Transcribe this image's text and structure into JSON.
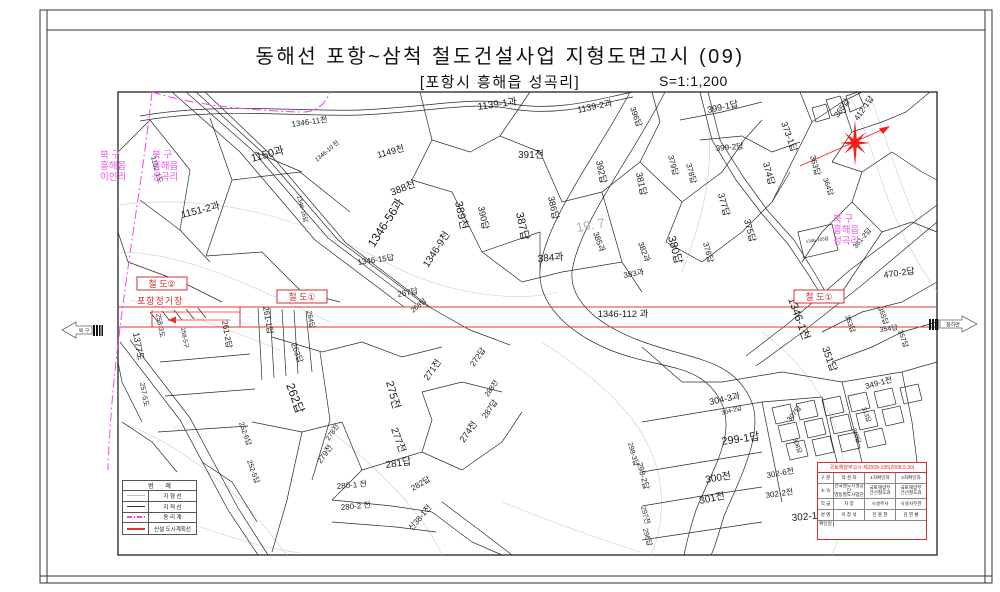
{
  "title": {
    "main": "동해선 포항~삼척 철도건설사업 지형도면고시 (09)",
    "sub": "[포항시 흥해읍 성곡리]",
    "scale": "S=1:1,200"
  },
  "colors": {
    "railway_red": "#e03434",
    "boundary_magenta": "#ff3cff",
    "admin_text_magenta": "#ee55ee",
    "cadastral_black": "#2b2b2b",
    "topo_gray": "#cdcdcd",
    "star_red": "#ff1a1a"
  },
  "edges": {
    "left": {
      "label": "북 구"
    },
    "right": {
      "label": "청하면"
    }
  },
  "rail": {
    "line_label": "1346-112 과",
    "station_label": "포항정거장",
    "boxes": [
      {
        "t": "철  도②",
        "x": 137,
        "y": 277
      },
      {
        "t": "철  도①",
        "x": 277,
        "y": 290
      },
      {
        "t": "철  도①",
        "x": 794,
        "y": 290
      }
    ]
  },
  "admin_labels": [
    {
      "x": 100,
      "y": 158,
      "lines": [
        "북   구",
        "흥해읍",
        "이인리"
      ]
    },
    {
      "x": 152,
      "y": 158,
      "lines": [
        "북   구",
        "흥해읍",
        "성곡리"
      ]
    },
    {
      "x": 833,
      "y": 222,
      "lines": [
        "북   구",
        "흥해읍",
        "성곡리"
      ]
    }
  ],
  "legend": {
    "header": "범  례",
    "items": [
      {
        "label": "지  형  선"
      },
      {
        "label": "지  적  선"
      },
      {
        "label": "동  리  계"
      },
      {
        "label": "신설 도시계획선"
      }
    ]
  },
  "title_block": {
    "header": "국토해양부고시  제2008-195(2008.5.30)",
    "rows": [
      {
        "label": "구 분",
        "cells": [
          "작 성 자",
          "1차확인자",
          "2차확인자"
        ]
      },
      {
        "label": "소 속",
        "cells": [
          "한국철도시설공단\n영동철도사업단",
          "국토해양부\n간선철도과",
          "국토해양부\n간선철도과"
        ]
      },
      {
        "label": "직 급",
        "cells": [
          "차 장",
          "시설주사",
          "시설사무관"
        ]
      },
      {
        "label": "성 명",
        "cells": [
          "이 창 석",
          "민 홍 현",
          "김 영 룡"
        ]
      },
      {
        "label": "확인일",
        "cells": [
          "",
          "",
          ""
        ]
      }
    ]
  },
  "map": {
    "parcels": [
      {
        "t": "1150과",
        "x": 252,
        "y": 162,
        "r": -15,
        "s": 11
      },
      {
        "t": "1151-2과",
        "x": 182,
        "y": 218,
        "r": -14,
        "s": 10
      },
      {
        "t": "1152-1도",
        "x": 151,
        "y": 157,
        "r": 75,
        "s": 7
      },
      {
        "t": "1346-11천",
        "x": 292,
        "y": 127,
        "r": -8,
        "s": 8
      },
      {
        "t": "1149천",
        "x": 378,
        "y": 158,
        "r": -15,
        "s": 9
      },
      {
        "t": "388천",
        "x": 392,
        "y": 196,
        "r": -22,
        "s": 10
      },
      {
        "t": "1346-56과",
        "x": 374,
        "y": 248,
        "r": -57,
        "s": 12
      },
      {
        "t": "1346-9천",
        "x": 428,
        "y": 268,
        "r": -57,
        "s": 10
      },
      {
        "t": "1346-15답",
        "x": 358,
        "y": 265,
        "r": -8,
        "s": 8
      },
      {
        "t": "1346-10 천",
        "x": 317,
        "y": 162,
        "r": -40,
        "s": 6
      },
      {
        "t": "1346-16답",
        "x": 297,
        "y": 196,
        "r": 75,
        "s": 6
      },
      {
        "t": "1139-1과",
        "x": 478,
        "y": 110,
        "r": -8,
        "s": 10
      },
      {
        "t": "1139-2과",
        "x": 578,
        "y": 113,
        "r": -12,
        "s": 9
      },
      {
        "t": "391전",
        "x": 518,
        "y": 158,
        "r": 0,
        "s": 10
      },
      {
        "t": "389천",
        "x": 455,
        "y": 202,
        "r": 78,
        "s": 11
      },
      {
        "t": "390답",
        "x": 478,
        "y": 207,
        "r": 78,
        "s": 9
      },
      {
        "t": "387답",
        "x": 516,
        "y": 213,
        "r": 78,
        "s": 11
      },
      {
        "t": "386답",
        "x": 548,
        "y": 197,
        "r": 78,
        "s": 9
      },
      {
        "t": "392답",
        "x": 596,
        "y": 161,
        "r": 78,
        "s": 9
      },
      {
        "t": "381답",
        "x": 636,
        "y": 173,
        "r": 78,
        "s": 9
      },
      {
        "t": "396답",
        "x": 630,
        "y": 108,
        "r": 70,
        "s": 8
      },
      {
        "t": "384과",
        "x": 538,
        "y": 262,
        "r": -5,
        "s": 10
      },
      {
        "t": "383과",
        "x": 624,
        "y": 278,
        "r": -10,
        "s": 8
      },
      {
        "t": "385과",
        "x": 593,
        "y": 233,
        "r": 70,
        "s": 8
      },
      {
        "t": "382과",
        "x": 638,
        "y": 243,
        "r": 70,
        "s": 8
      },
      {
        "t": "380답",
        "x": 668,
        "y": 237,
        "r": 75,
        "s": 11
      },
      {
        "t": "378답",
        "x": 686,
        "y": 164,
        "r": 75,
        "s": 8
      },
      {
        "t": "379답",
        "x": 668,
        "y": 156,
        "r": 75,
        "s": 8
      },
      {
        "t": "377답",
        "x": 718,
        "y": 194,
        "r": 75,
        "s": 9
      },
      {
        "t": "376답",
        "x": 703,
        "y": 243,
        "r": 75,
        "s": 8
      },
      {
        "t": "375답",
        "x": 744,
        "y": 220,
        "r": 75,
        "s": 9
      },
      {
        "t": "374답",
        "x": 763,
        "y": 163,
        "r": 75,
        "s": 9
      },
      {
        "t": "373-1답",
        "x": 781,
        "y": 123,
        "r": 70,
        "s": 9
      },
      {
        "t": "399-1답",
        "x": 708,
        "y": 113,
        "r": -12,
        "s": 9
      },
      {
        "t": "399-2답",
        "x": 716,
        "y": 151,
        "r": -5,
        "s": 8
      },
      {
        "t": "412-1답",
        "x": 858,
        "y": 121,
        "r": -55,
        "s": 8
      },
      {
        "t": "365답",
        "x": 838,
        "y": 118,
        "r": -55,
        "s": 8
      },
      {
        "t": "363답",
        "x": 810,
        "y": 156,
        "r": 75,
        "s": 8
      },
      {
        "t": "364답",
        "x": 823,
        "y": 179,
        "r": 70,
        "s": 7
      },
      {
        "t": "19. 7",
        "x": 577,
        "y": 232,
        "r": -10,
        "s": 13,
        "c": "#b3b3b3"
      },
      {
        "t": "1346-105답",
        "x": 806,
        "y": 243,
        "r": -8,
        "s": 4.5
      },
      {
        "t": "1346-1천",
        "x": 788,
        "y": 299,
        "r": 70,
        "s": 11
      },
      {
        "t": "470-2답",
        "x": 884,
        "y": 278,
        "r": -8,
        "s": 9
      },
      {
        "t": "381-2답",
        "x": 856,
        "y": 249,
        "r": -50,
        "s": 7
      },
      {
        "t": "355답",
        "x": 878,
        "y": 308,
        "r": 70,
        "s": 7
      },
      {
        "t": "353답",
        "x": 845,
        "y": 316,
        "r": 70,
        "s": 7
      },
      {
        "t": "354답",
        "x": 880,
        "y": 332,
        "r": -8,
        "s": 7
      },
      {
        "t": "357답",
        "x": 898,
        "y": 331,
        "r": 70,
        "s": 7
      },
      {
        "t": "351답",
        "x": 822,
        "y": 348,
        "r": 70,
        "s": 10
      },
      {
        "t": "349-1전",
        "x": 866,
        "y": 389,
        "r": -15,
        "s": 8
      },
      {
        "t": "304-3과",
        "x": 710,
        "y": 405,
        "r": -12,
        "s": 9
      },
      {
        "t": "304-2답",
        "x": 722,
        "y": 415,
        "r": -15,
        "s": 6
      },
      {
        "t": "299-1답",
        "x": 722,
        "y": 445,
        "r": -8,
        "s": 11
      },
      {
        "t": "307답",
        "x": 790,
        "y": 422,
        "r": -50,
        "s": 7
      },
      {
        "t": "308답",
        "x": 793,
        "y": 439,
        "r": 70,
        "s": 6
      },
      {
        "t": "310답",
        "x": 852,
        "y": 429,
        "r": 70,
        "s": 6
      },
      {
        "t": "313답",
        "x": 862,
        "y": 408,
        "r": 70,
        "s": 6
      },
      {
        "t": "300전",
        "x": 706,
        "y": 483,
        "r": -10,
        "s": 10
      },
      {
        "t": "301전",
        "x": 700,
        "y": 504,
        "r": -12,
        "s": 10
      },
      {
        "t": "302-6전",
        "x": 767,
        "y": 478,
        "r": -10,
        "s": 8
      },
      {
        "t": "302-2전",
        "x": 766,
        "y": 498,
        "r": -8,
        "s": 8
      },
      {
        "t": "302-1전",
        "x": 792,
        "y": 521,
        "r": -5,
        "s": 10
      },
      {
        "t": "298-2답",
        "x": 637,
        "y": 463,
        "r": 75,
        "s": 8
      },
      {
        "t": "298-3답",
        "x": 628,
        "y": 443,
        "r": 75,
        "s": 7
      },
      {
        "t": "297전",
        "x": 641,
        "y": 507,
        "r": 75,
        "s": 7
      },
      {
        "t": "296답",
        "x": 643,
        "y": 529,
        "r": 75,
        "s": 7
      },
      {
        "t": "1377도",
        "x": 133,
        "y": 333,
        "r": 80,
        "s": 9
      },
      {
        "t": "258-3도",
        "x": 156,
        "y": 314,
        "r": 80,
        "s": 7
      },
      {
        "t": "258-5구",
        "x": 181,
        "y": 328,
        "r": 80,
        "s": 6
      },
      {
        "t": "257-5도",
        "x": 140,
        "y": 383,
        "r": 80,
        "s": 7
      },
      {
        "t": "261-2답",
        "x": 222,
        "y": 321,
        "r": 80,
        "s": 8
      },
      {
        "t": "261-1답",
        "x": 263,
        "y": 307,
        "r": 80,
        "s": 8
      },
      {
        "t": "264답",
        "x": 307,
        "y": 311,
        "r": 80,
        "s": 7
      },
      {
        "t": "263답",
        "x": 291,
        "y": 344,
        "r": 70,
        "s": 8
      },
      {
        "t": "262답",
        "x": 286,
        "y": 385,
        "r": 70,
        "s": 12
      },
      {
        "t": "267답",
        "x": 398,
        "y": 297,
        "r": -10,
        "s": 8
      },
      {
        "t": "268답",
        "x": 413,
        "y": 313,
        "r": -40,
        "s": 7
      },
      {
        "t": "252-6답",
        "x": 239,
        "y": 423,
        "r": 70,
        "s": 7
      },
      {
        "t": "252-5답",
        "x": 247,
        "y": 461,
        "r": 70,
        "s": 7
      },
      {
        "t": "252-2답",
        "x": 176,
        "y": 491,
        "r": 75,
        "s": 9
      },
      {
        "t": "275전",
        "x": 386,
        "y": 382,
        "r": 75,
        "s": 11
      },
      {
        "t": "271전",
        "x": 428,
        "y": 381,
        "r": -55,
        "s": 9
      },
      {
        "t": "272답",
        "x": 474,
        "y": 367,
        "r": -55,
        "s": 8
      },
      {
        "t": "277전",
        "x": 391,
        "y": 429,
        "r": 70,
        "s": 10
      },
      {
        "t": "274전",
        "x": 464,
        "y": 443,
        "r": -55,
        "s": 9
      },
      {
        "t": "287답",
        "x": 486,
        "y": 419,
        "r": -55,
        "s": 8
      },
      {
        "t": "288전",
        "x": 488,
        "y": 397,
        "r": -55,
        "s": 7
      },
      {
        "t": "281답",
        "x": 386,
        "y": 468,
        "r": -8,
        "s": 10
      },
      {
        "t": "282답",
        "x": 413,
        "y": 491,
        "r": -30,
        "s": 8
      },
      {
        "t": "279전",
        "x": 321,
        "y": 464,
        "r": -55,
        "s": 8
      },
      {
        "t": "278전",
        "x": 329,
        "y": 441,
        "r": -55,
        "s": 7
      },
      {
        "t": "280-1 전",
        "x": 337,
        "y": 489,
        "r": -5,
        "s": 8
      },
      {
        "t": "280-2 전",
        "x": 341,
        "y": 510,
        "r": -5,
        "s": 8
      },
      {
        "t": "신38-1천",
        "x": 412,
        "y": 531,
        "r": -50,
        "s": 8
      }
    ]
  }
}
